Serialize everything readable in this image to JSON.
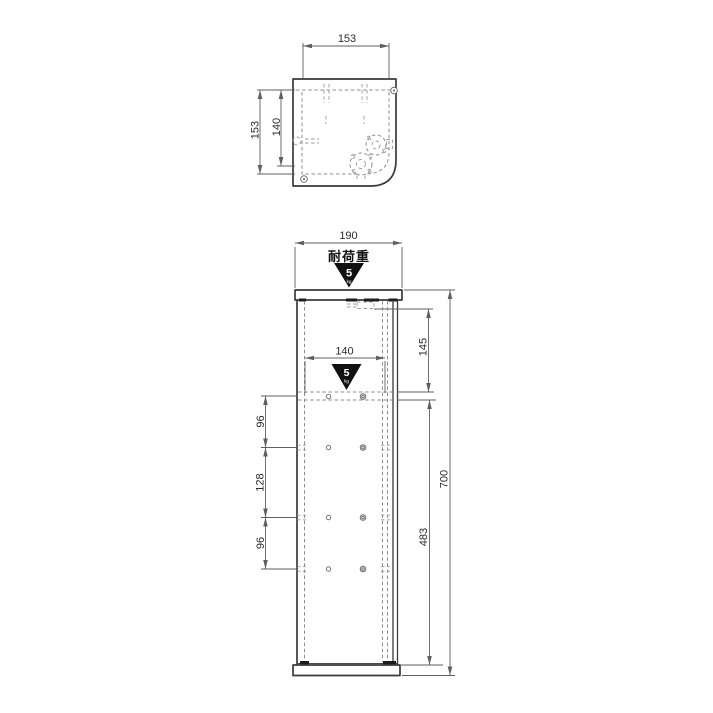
{
  "drawing": {
    "top_view": {
      "dim_width": "153",
      "dim_depth": "153",
      "dim_depth_inner": "140"
    },
    "front_view": {
      "dim_width": "190",
      "load_label": "耐荷重",
      "load_value": "5",
      "load_unit": "kg",
      "dim_shelf_width": "140",
      "dim_top_section": "145",
      "dim_shelf_section": "483",
      "dim_total_height": "700",
      "dim_left_segments": [
        "96",
        "128",
        "96"
      ]
    },
    "colors": {
      "background": "#ffffff",
      "outline": "#3a3a3a",
      "hidden_line": "#8d8d8d",
      "dimension_line": "#5f5f5f",
      "badge_fill": "#111111",
      "badge_text": "#ffffff"
    }
  }
}
